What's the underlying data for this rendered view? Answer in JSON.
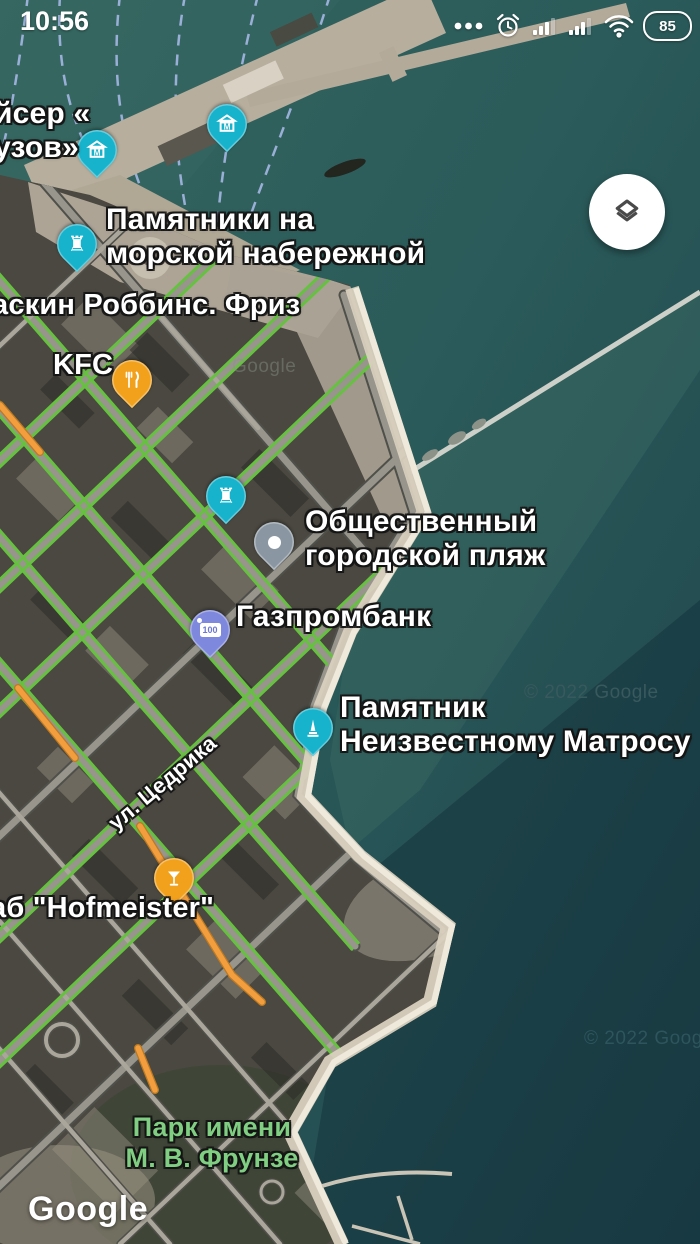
{
  "status_bar": {
    "time": "10:56",
    "battery_percent": "85"
  },
  "icons": {
    "museum_letter": "M",
    "rook": "♜"
  },
  "map": {
    "logo": "Google",
    "watermarks": {
      "mid": "© 2022 Google",
      "bottom": "© 2022 Google",
      "pier": "Google"
    },
    "street_label": "ул. Цедрика",
    "pois": {
      "cruiser_line1": "йсер «",
      "cruiser_line2": "узов»",
      "monuments_line1": "Памятники на",
      "monuments_line2": "морской набережной",
      "baskin": "аскин Роббинс. Фриз",
      "kfc": "KFC",
      "beach_line1": "Общественный",
      "beach_line2": "городской пляж",
      "bank": "Газпромбанк",
      "bank_badge": "100",
      "sailor_line1": "Памятник",
      "sailor_line2": "Неизвестному Матросу",
      "pub": "аб \"Hofmeister\"",
      "park_line1": "Парк имени",
      "park_line2": "М. В. Фрунзе"
    }
  },
  "colors": {
    "pin_teal": "#17b2cb",
    "pin_orange": "#f2a11c",
    "pin_gray": "#8a97a2",
    "pin_bank": "#7e88dc",
    "road_green": "#67c141",
    "road_orange": "#f29d3e",
    "park_text_green": "#7fce82"
  }
}
